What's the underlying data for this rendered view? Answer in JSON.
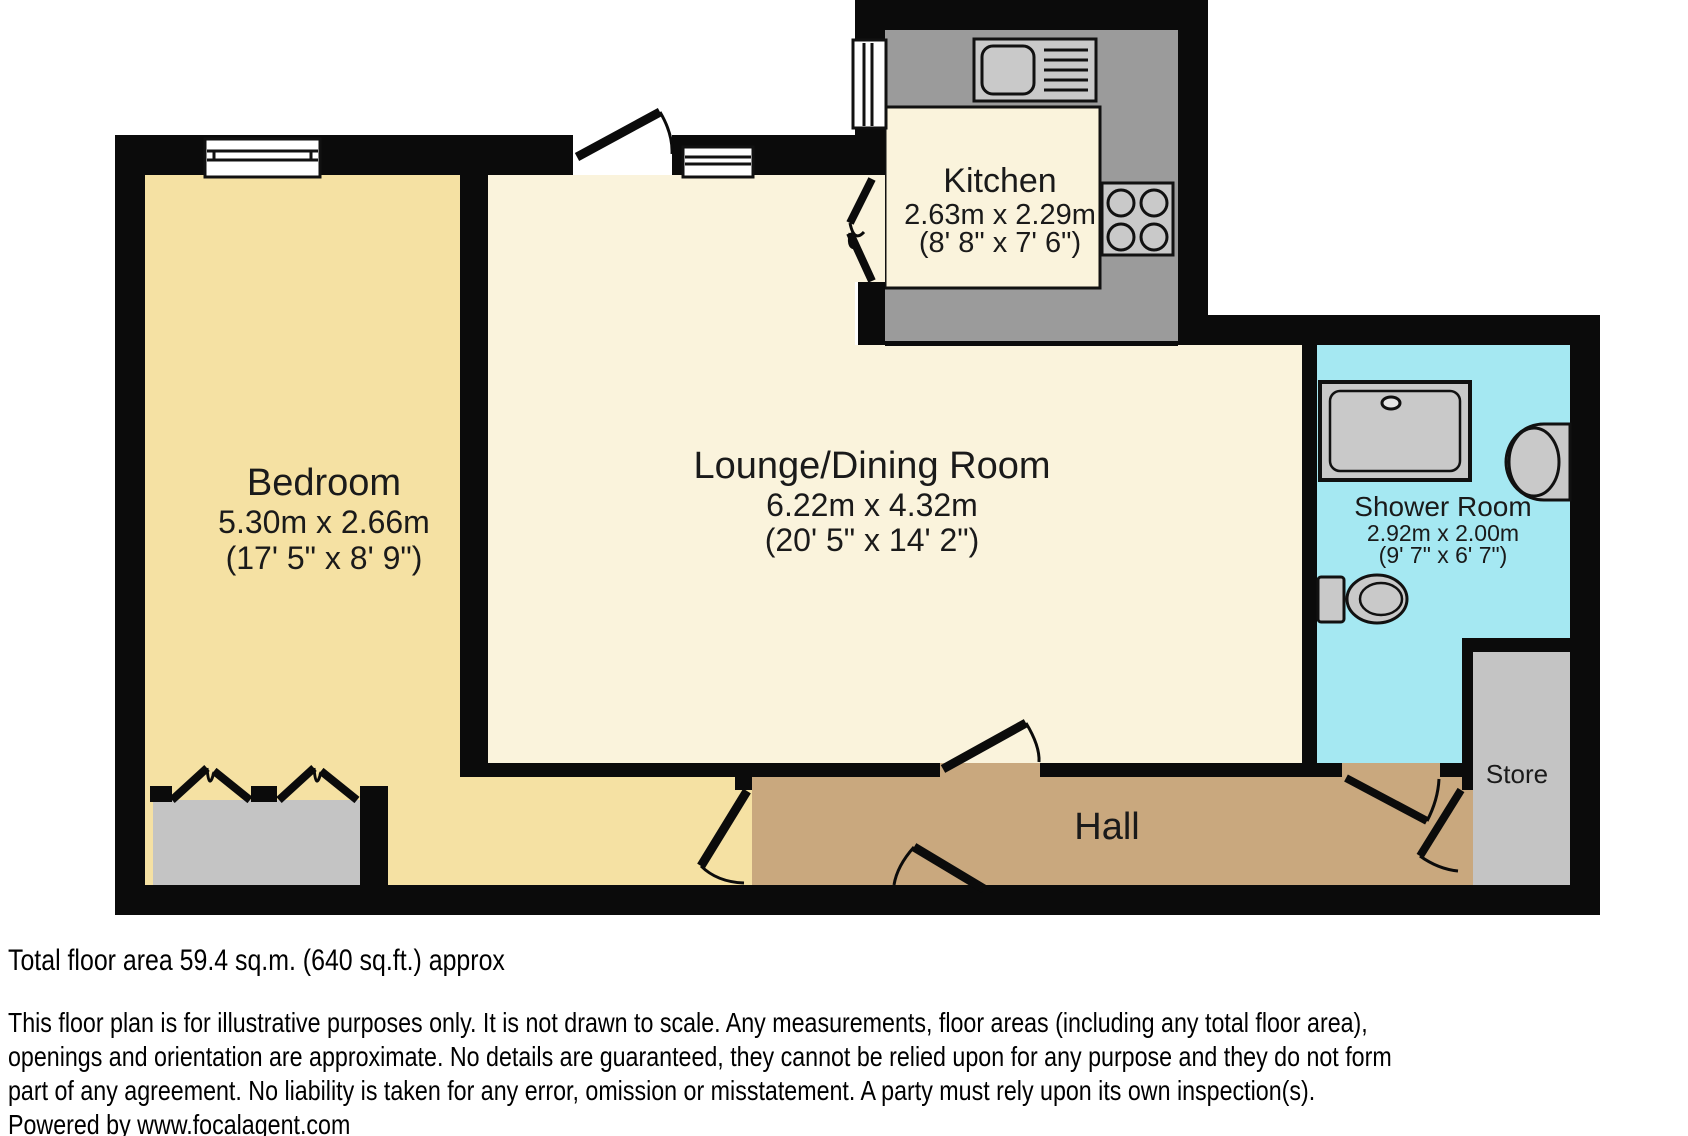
{
  "rooms": {
    "bedroom": {
      "name": "Bedroom",
      "metric": "5.30m x 2.66m",
      "imperial": "(17' 5\" x 8' 9\")"
    },
    "lounge": {
      "name": "Lounge/Dining Room",
      "metric": "6.22m x 4.32m",
      "imperial": "(20' 5\" x 14' 2\")"
    },
    "kitchen": {
      "name": "Kitchen",
      "metric": "2.63m x 2.29m",
      "imperial": "(8' 8\" x 7' 6\")"
    },
    "shower": {
      "name": "Shower Room",
      "metric": "2.92m x 2.00m",
      "imperial": "(9' 7\" x 6' 7\")"
    },
    "store": {
      "name": "Store"
    },
    "hall": {
      "name": "Hall"
    }
  },
  "footer": {
    "total_area": "Total floor area 59.4 sq.m. (640 sq.ft.) approx",
    "disclaimer_lines": [
      "This floor plan is for illustrative purposes only. It is not drawn to scale. Any measurements, floor areas (including any total floor area),",
      "openings and orientation are approximate. No details are guaranteed, they cannot be relied upon for any purpose and they do not form",
      "part of any agreement. No liability is taken for any error, omission or misstatement. A party must rely upon its own inspection(s).",
      "Powered by www.focalagent.com"
    ]
  },
  "colors": {
    "wall": "#0b0b0b",
    "bedroom_floor": "#f5e1a3",
    "lounge_floor": "#faf3dc",
    "kitchen_floor": "#faf3dc",
    "hall_floor": "#c9a87e",
    "shower_floor": "#a5e8f2",
    "store_floor": "#c4c4c4",
    "counter": "#9b9b9b",
    "fixture": "#c9c9c9",
    "wardrobe": "#c4c4c4",
    "window": "#ffffff"
  }
}
